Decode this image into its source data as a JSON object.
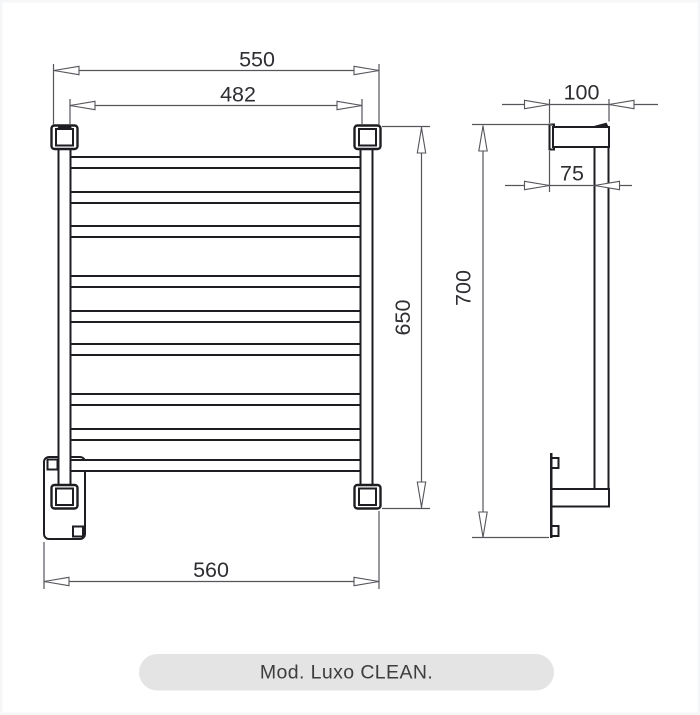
{
  "front_view": {
    "width_top": "550",
    "width_inner": "482",
    "height": "650",
    "width_bottom": "560",
    "rung_count": 9
  },
  "side_view": {
    "depth_top": "100",
    "bar_offset": "75",
    "height_overall": "700"
  },
  "footer": {
    "model_label": "Mod. Luxo CLEAN."
  },
  "colors": {
    "object_line": "#1e1e22",
    "dimension_line": "#55565c",
    "dimension_text": "#2e2e33",
    "pill_background": "#e4e4e4",
    "pill_text": "#3d3d3d",
    "canvas_background": "#ffffff"
  }
}
